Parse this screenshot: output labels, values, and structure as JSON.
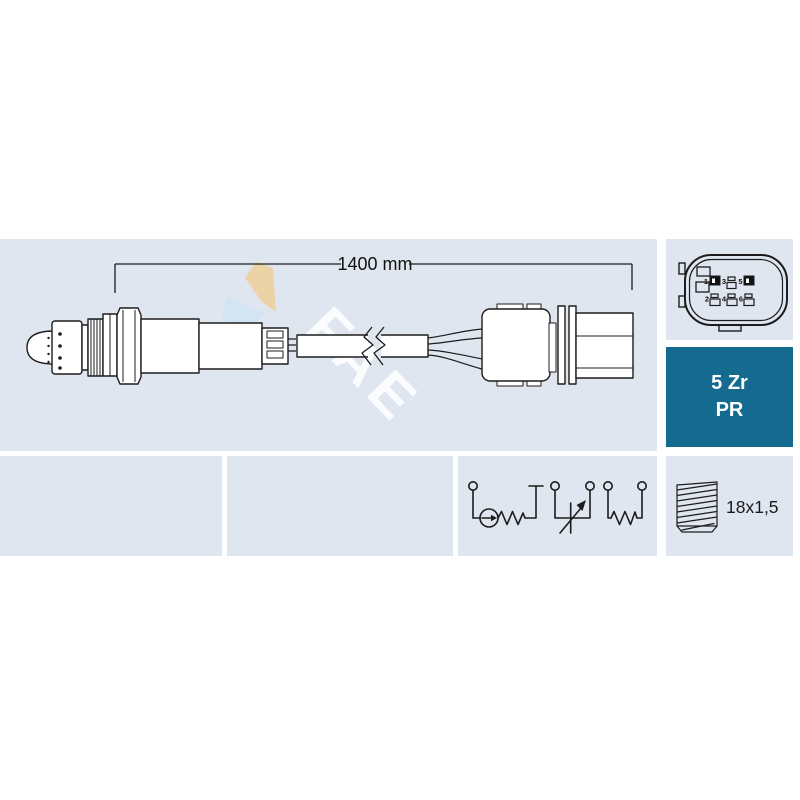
{
  "colors": {
    "panel_bg": "#e0e6ef",
    "badge_bg": "#156a90",
    "line": "#1c1c1c",
    "watermark_tan": "#ecd2a2",
    "watermark_blue": "#cfe3f2",
    "watermark_text_color": "#ffffff"
  },
  "main_panel": {
    "dimension_label": "1400 mm",
    "watermark_text": "FAE"
  },
  "connector_panel": {
    "pin_labels": [
      "1",
      "2",
      "3",
      "4",
      "5",
      "6"
    ]
  },
  "badge": {
    "line1": "5 Zr",
    "line2": "PR"
  },
  "thread_panel": {
    "label": "18x1,5"
  }
}
